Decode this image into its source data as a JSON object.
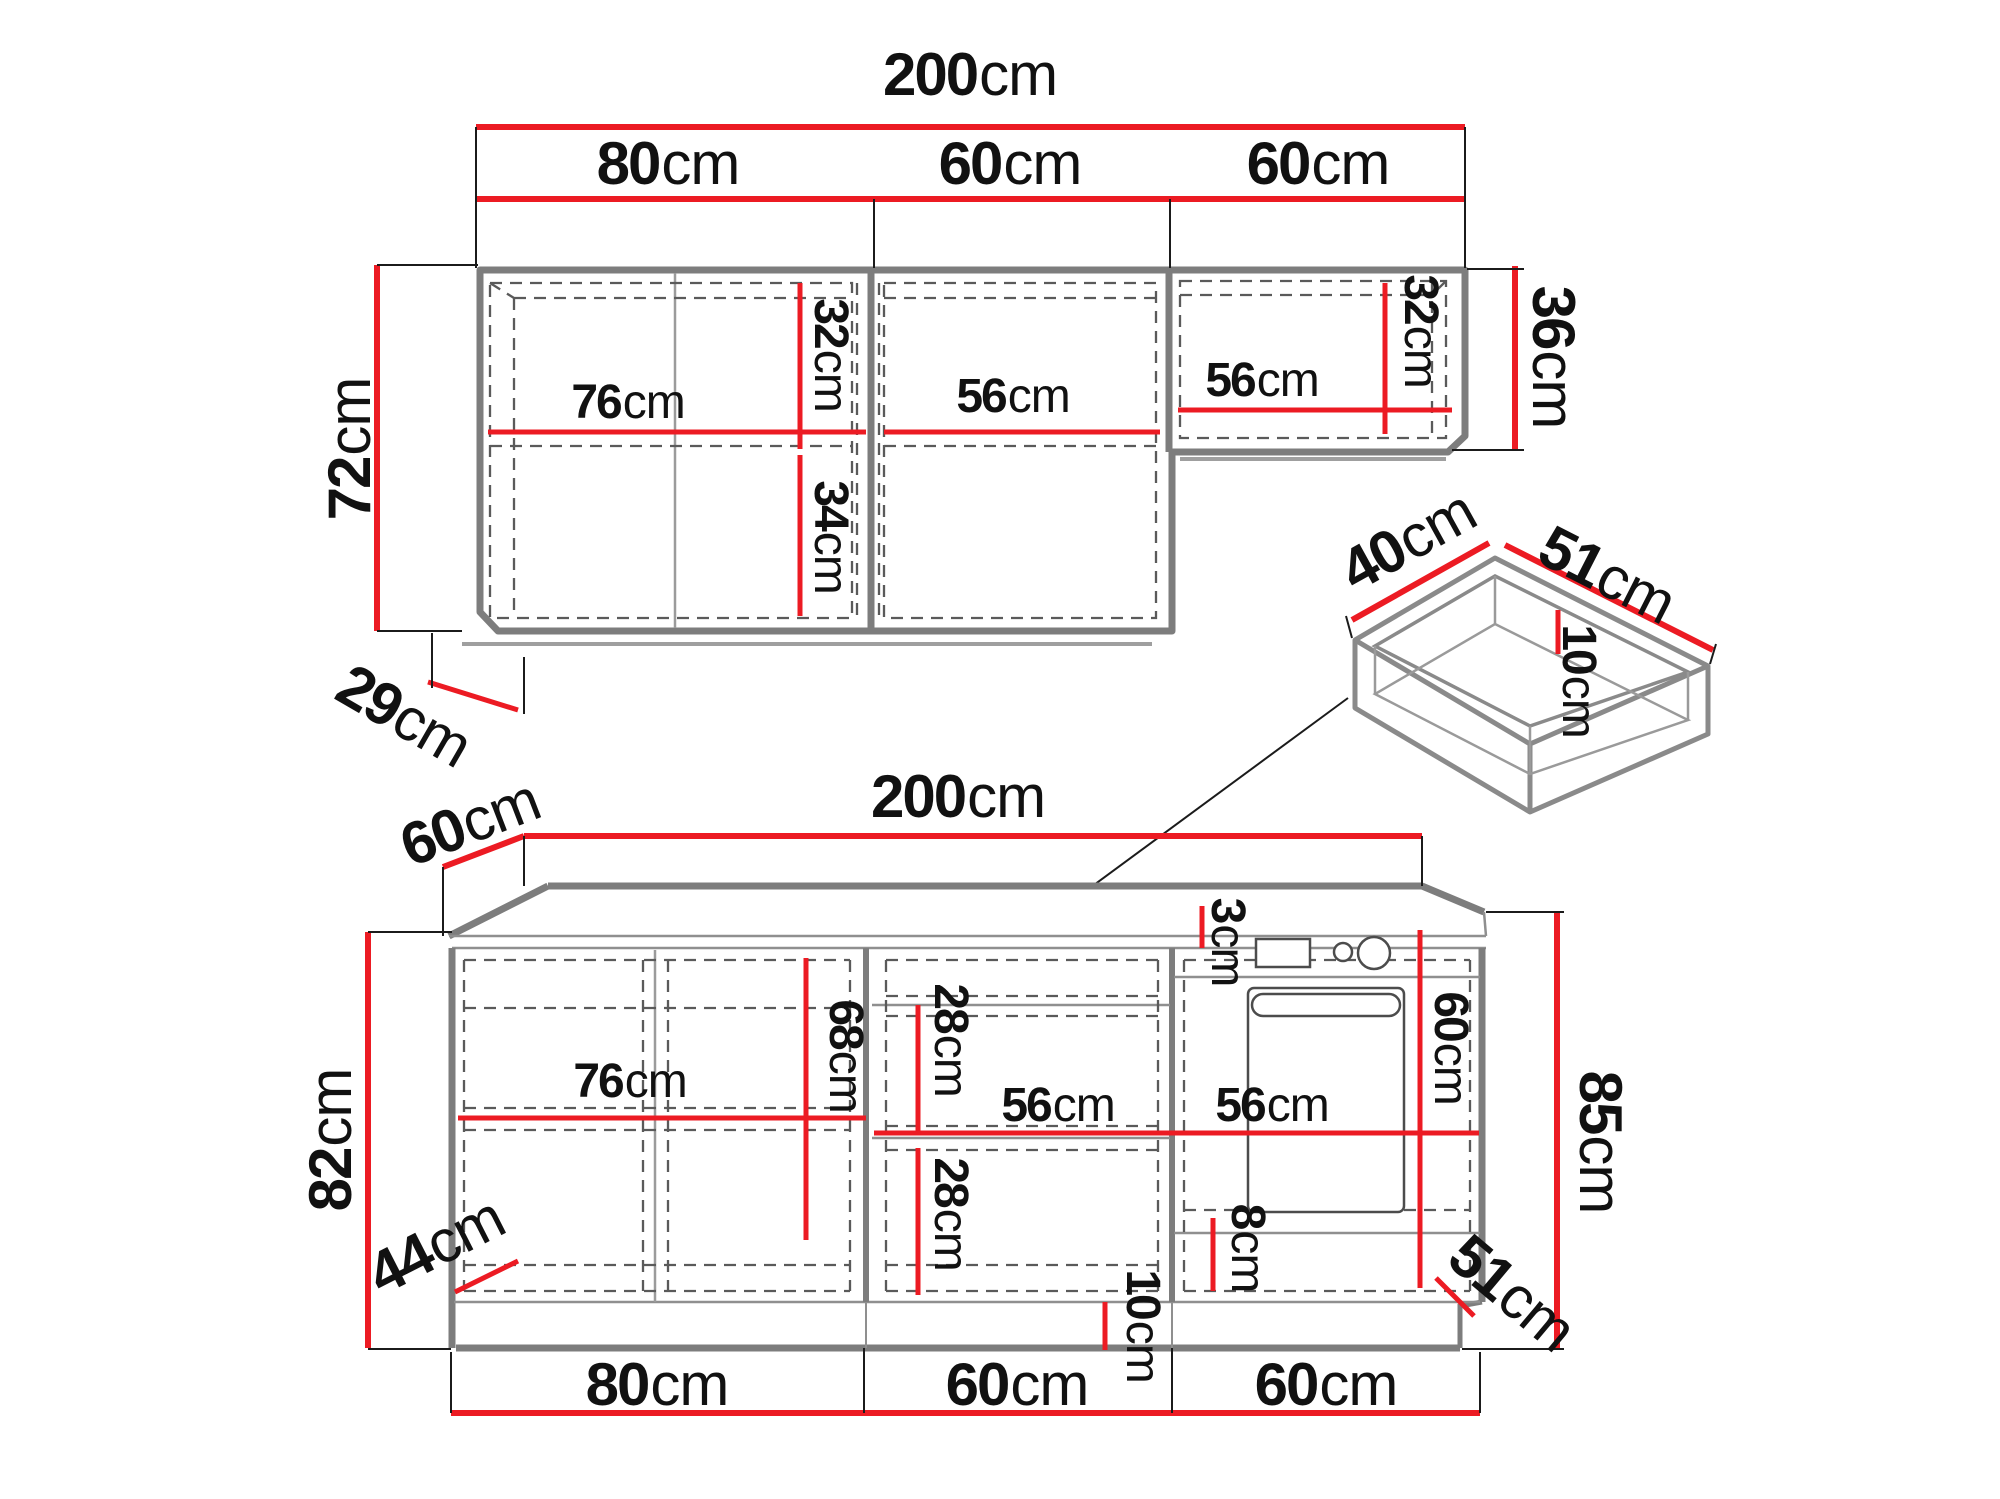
{
  "figure": {
    "kind": "kitchen-cabinet-dimension-diagram",
    "accent_color": "#ec1b23",
    "outline_color": "#7d7d7d",
    "unit": "cm"
  },
  "dims": {
    "wall": {
      "total": {
        "v": "200",
        "u": "cm"
      },
      "s80": {
        "v": "80",
        "u": "cm"
      },
      "s60a": {
        "v": "60",
        "u": "cm"
      },
      "s60b": {
        "v": "60",
        "u": "cm"
      },
      "h72": {
        "v": "72",
        "u": "cm"
      },
      "w76": {
        "v": "76",
        "u": "cm"
      },
      "h32a": {
        "v": "32",
        "u": "cm"
      },
      "h34": {
        "v": "34",
        "u": "cm"
      },
      "w56m": {
        "v": "56",
        "u": "cm"
      },
      "w56r": {
        "v": "56",
        "u": "cm"
      },
      "h32r": {
        "v": "32",
        "u": "cm"
      },
      "h36": {
        "v": "36",
        "u": "cm"
      },
      "d29": {
        "v": "29",
        "u": "cm"
      }
    },
    "drawer": {
      "w40": {
        "v": "40",
        "u": "cm"
      },
      "l51": {
        "v": "51",
        "u": "cm"
      },
      "d10": {
        "v": "10",
        "u": "cm"
      }
    },
    "base": {
      "d60": {
        "v": "60",
        "u": "cm"
      },
      "total": {
        "v": "200",
        "u": "cm"
      },
      "h82": {
        "v": "82",
        "u": "cm"
      },
      "h85": {
        "v": "85",
        "u": "cm"
      },
      "w76": {
        "v": "76",
        "u": "cm"
      },
      "h68": {
        "v": "68",
        "u": "cm"
      },
      "h28a": {
        "v": "28",
        "u": "cm"
      },
      "w56m": {
        "v": "56",
        "u": "cm"
      },
      "h28b": {
        "v": "28",
        "u": "cm"
      },
      "t3": {
        "v": "3",
        "u": "cm"
      },
      "w56r": {
        "v": "56",
        "u": "cm"
      },
      "h60": {
        "v": "60",
        "u": "cm"
      },
      "h8": {
        "v": "8",
        "u": "cm"
      },
      "d51": {
        "v": "51",
        "u": "cm"
      },
      "p10": {
        "v": "10",
        "u": "cm"
      },
      "d44": {
        "v": "44",
        "u": "cm"
      },
      "b80": {
        "v": "80",
        "u": "cm"
      },
      "b60a": {
        "v": "60",
        "u": "cm"
      },
      "b60b": {
        "v": "60",
        "u": "cm"
      }
    }
  }
}
